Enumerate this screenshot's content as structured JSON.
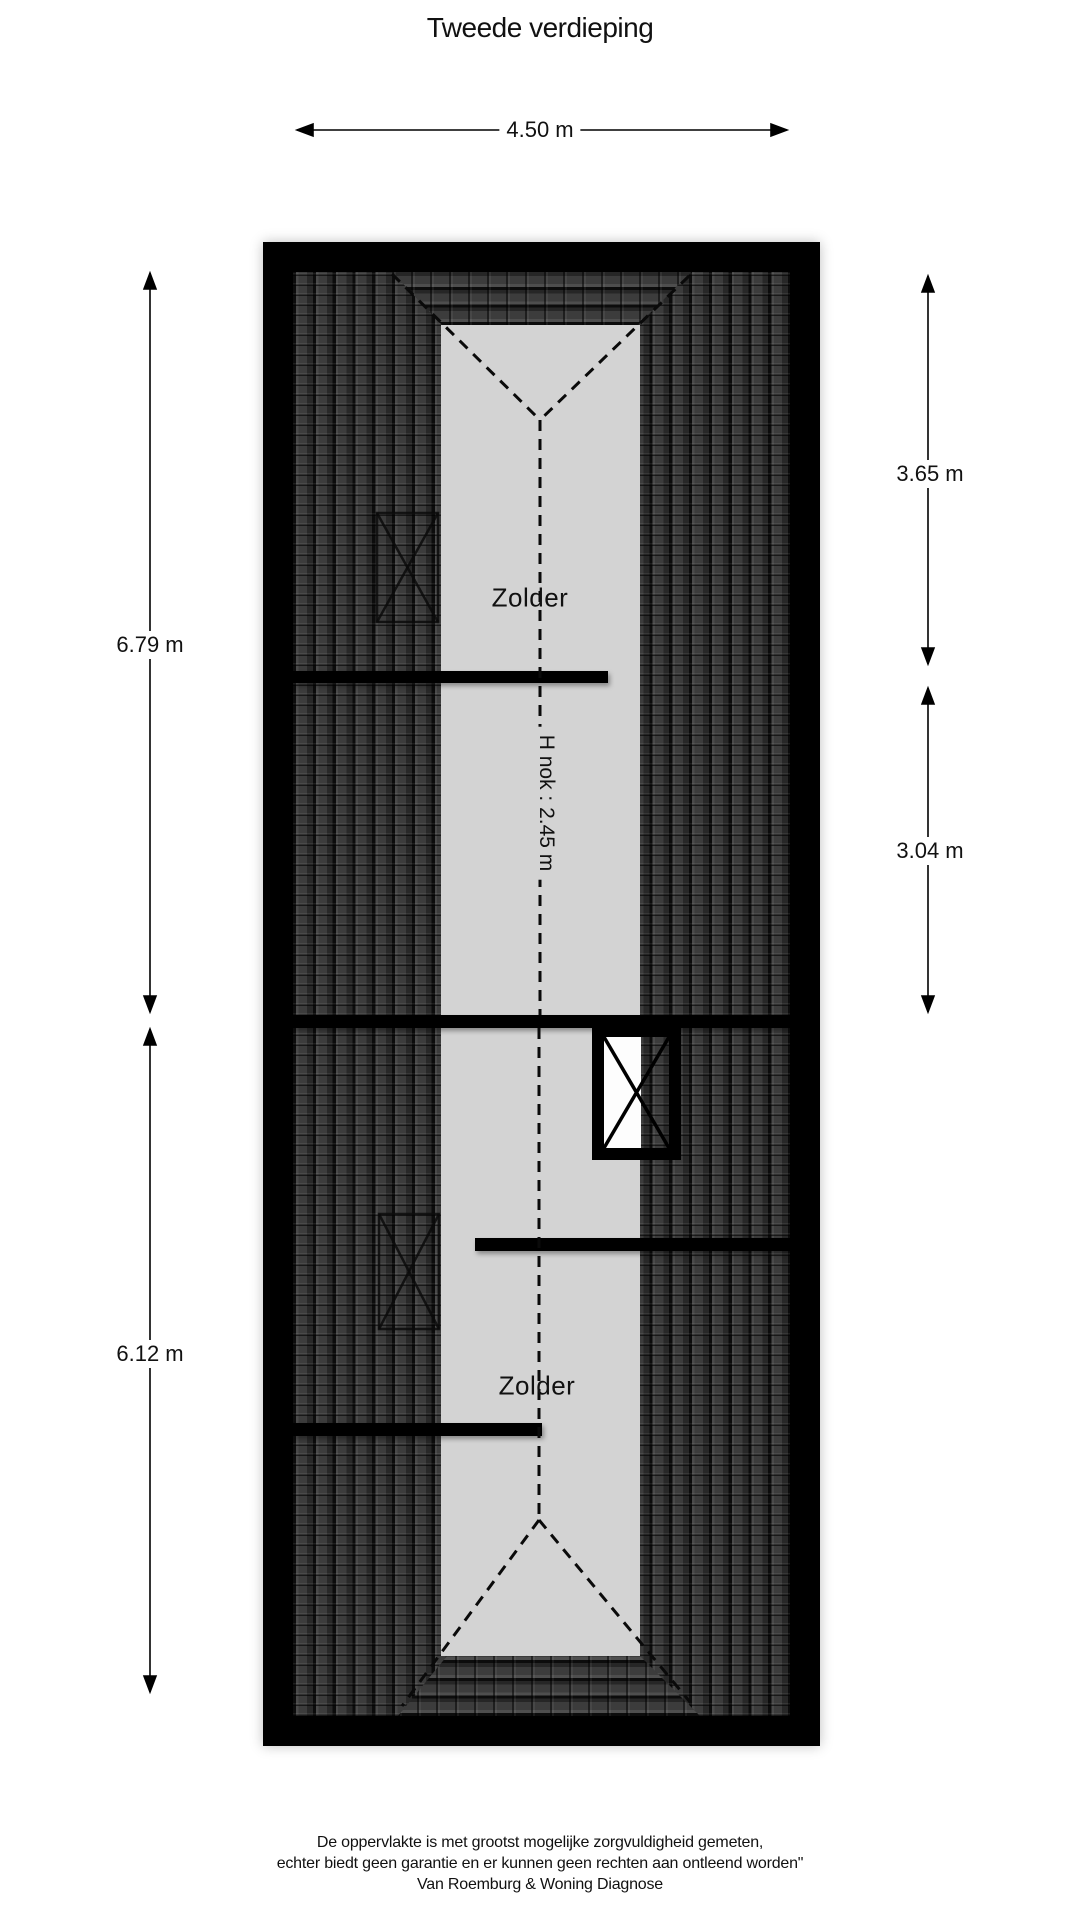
{
  "page": {
    "title": "Tweede verdieping"
  },
  "dimensions": {
    "width_top": {
      "label": "4.50 m"
    },
    "left_upper": {
      "label": "6.79 m"
    },
    "left_lower": {
      "label": "6.12 m"
    },
    "right_upper": {
      "label": "3.65 m"
    },
    "right_lower": {
      "label": "3.04 m"
    }
  },
  "rooms": {
    "upper": {
      "label": "Zolder"
    },
    "lower": {
      "label": "Zolder"
    }
  },
  "annotations": {
    "ridge_height": "H nok : 2.45 m"
  },
  "footer": {
    "line1": "De oppervlakte is met grootst mogelijke zorgvuldigheid gemeten,",
    "line2": "echter biedt geen garantie en er kunnen geen rechten aan ontleend worden\"",
    "line3": "Van Roemburg & Woning Diagnose"
  },
  "colors": {
    "page_bg": "#ffffff",
    "wall": "#000000",
    "roof_tile": "#2f2f2f",
    "attic_floor": "#d3d3d3",
    "line": "#000000"
  }
}
